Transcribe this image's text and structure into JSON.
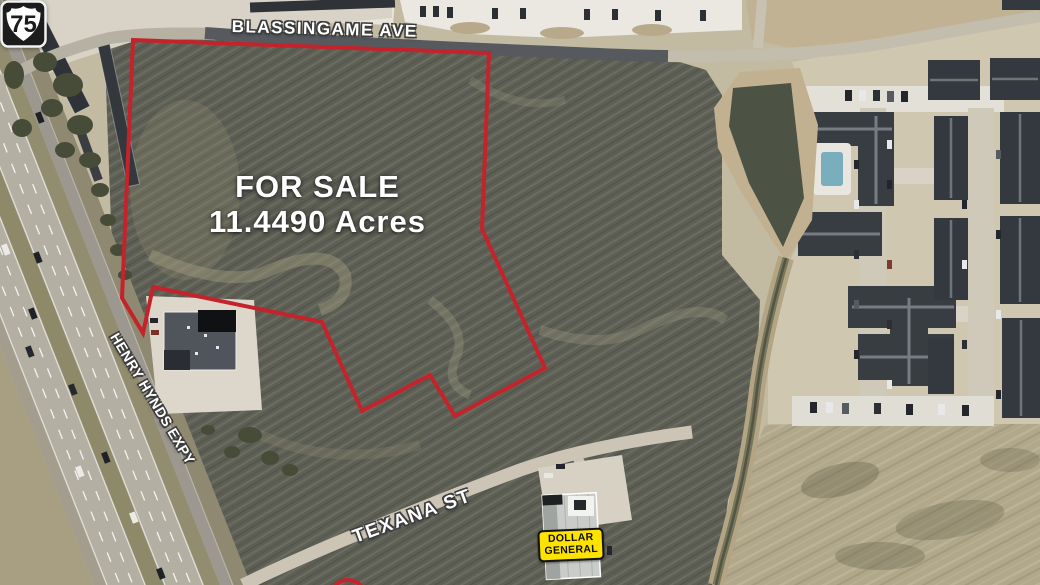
{
  "annotations": {
    "sale_label": {
      "title": "FOR SALE",
      "acreage": "11.4490 Acres"
    },
    "street_labels": {
      "blassingame": "BLASSINGAME AVE",
      "henry_hynds": "HENRY HYNDS EXPY",
      "texana": "TEXANA ST"
    },
    "highway_shield": {
      "route_number": "75"
    },
    "store_badge": {
      "line1": "DOLLAR",
      "line2": "GENERAL"
    },
    "parcel_boundary": {
      "stroke_color": "#c4232b",
      "stroke_width": "4",
      "points": "133,40 489,53 482,229 545,368 455,416 430,375 362,411 322,322 153,287 143,333 122,298"
    },
    "colors": {
      "boundary_red": "#c4232b",
      "badge_yellow": "#ffe300",
      "badge_text": "#0d0d0d",
      "label_white": "#ffffff",
      "shield_black": "#1c1c1c",
      "field_dark": "#5d5f55"
    }
  }
}
